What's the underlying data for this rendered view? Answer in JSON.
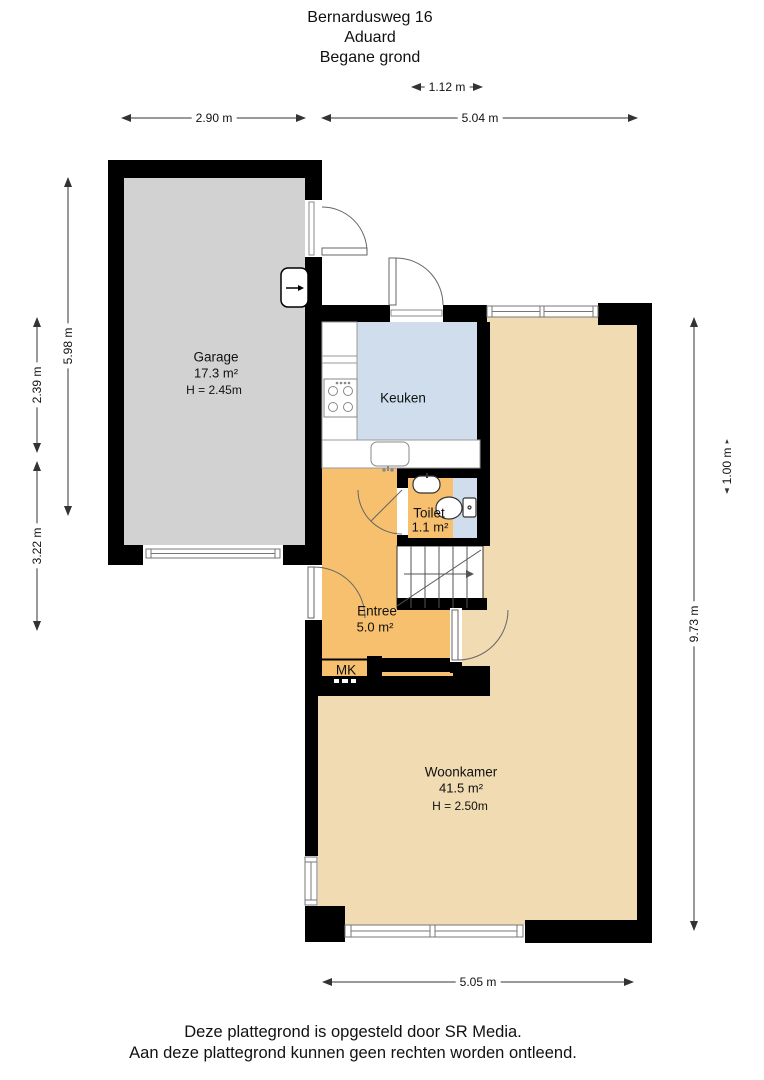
{
  "title": {
    "address": "Bernardusweg 16",
    "city": "Aduard",
    "floor": "Begane grond"
  },
  "rooms": {
    "garage": {
      "name": "Garage",
      "area": "17.3 m²",
      "height": "H = 2.45m"
    },
    "keuken": {
      "name": "Keuken"
    },
    "toilet": {
      "name": "Toilet",
      "area": "1.1 m²"
    },
    "entree": {
      "name": "Entree",
      "area": "5.0 m²"
    },
    "meterkast": {
      "name": "MK"
    },
    "woonkamer": {
      "name": "Woonkamer",
      "area": "41.5 m²",
      "height": "H = 2.50m"
    }
  },
  "dimensions": {
    "strip_width": "1.12 m",
    "garage_width": "2.90 m",
    "house_width_top": "5.04 m",
    "garage_depth": "5.98 m",
    "left_upper": "2.39 m",
    "left_lower": "3.22 m",
    "house_depth": "9.73 m",
    "right_offset": "1.00 m",
    "house_width_bottom": "5.05 m"
  },
  "footer": {
    "line1": "Deze plattegrond is opgesteld door SR Media.",
    "line2": "Aan deze plattegrond kunnen geen rechten worden ontleend."
  },
  "colors": {
    "wall": "#000000",
    "garage_floor": "#d2d2d2",
    "kitchen_floor": "#cfdded",
    "toilet_floor": "#cfdded",
    "entree_floor": "#f6c06e",
    "meterkast_floor": "#f6c06e",
    "woonkamer_floor": "#f0dbb2"
  }
}
